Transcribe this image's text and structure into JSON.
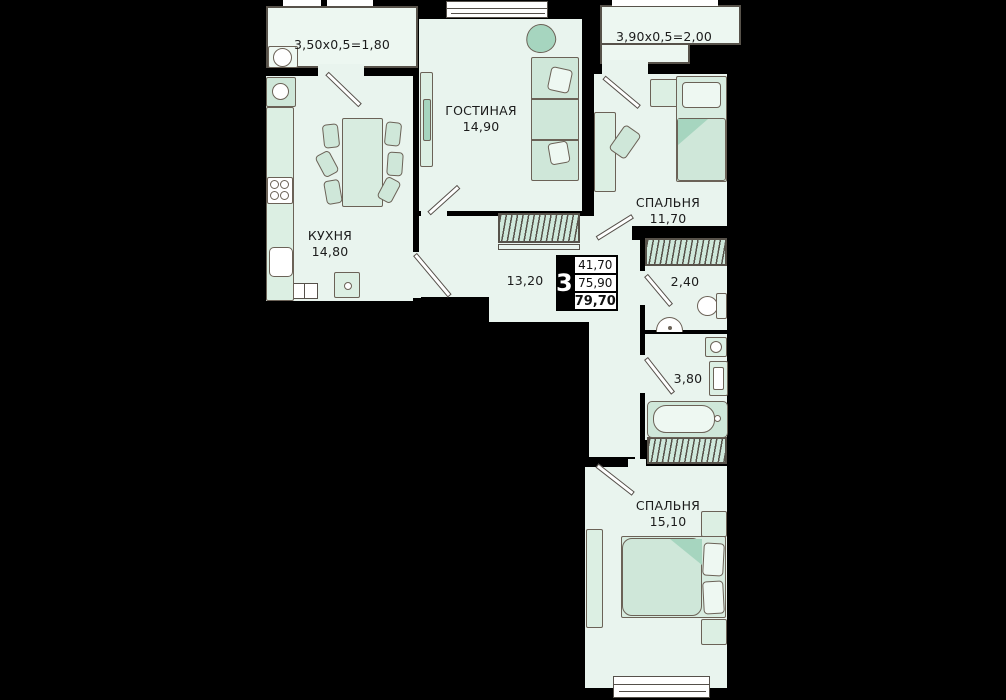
{
  "title": "3-room apartment floor plan",
  "colors": {
    "background": "#000000",
    "floor": "#e9f4ee",
    "furniture": "#cfe7d9",
    "furniture_accent": "#a6d5bf",
    "outline": "#57524a",
    "window": "#ffffff"
  },
  "rooms": {
    "balcony_kitchen": {
      "label": "3,50x0,5=1,80"
    },
    "kitchen": {
      "name": "КУХНЯ",
      "area": "14,80"
    },
    "living": {
      "name": "ГОСТИНАЯ",
      "area": "14,90"
    },
    "balcony_bedroom": {
      "label": "3,90x0,5=2,00"
    },
    "bedroom_top": {
      "name": "СПАЛЬНЯ",
      "area": "11,70"
    },
    "hall": {
      "area": "13,20"
    },
    "wc": {
      "area": "2,40"
    },
    "bathroom": {
      "area": "3,80"
    },
    "bedroom_bottom": {
      "name": "СПАЛЬНЯ",
      "area": "15,10"
    }
  },
  "info_box": {
    "rooms_count": "3",
    "values": [
      "41,70",
      "75,90",
      "79,70"
    ]
  }
}
